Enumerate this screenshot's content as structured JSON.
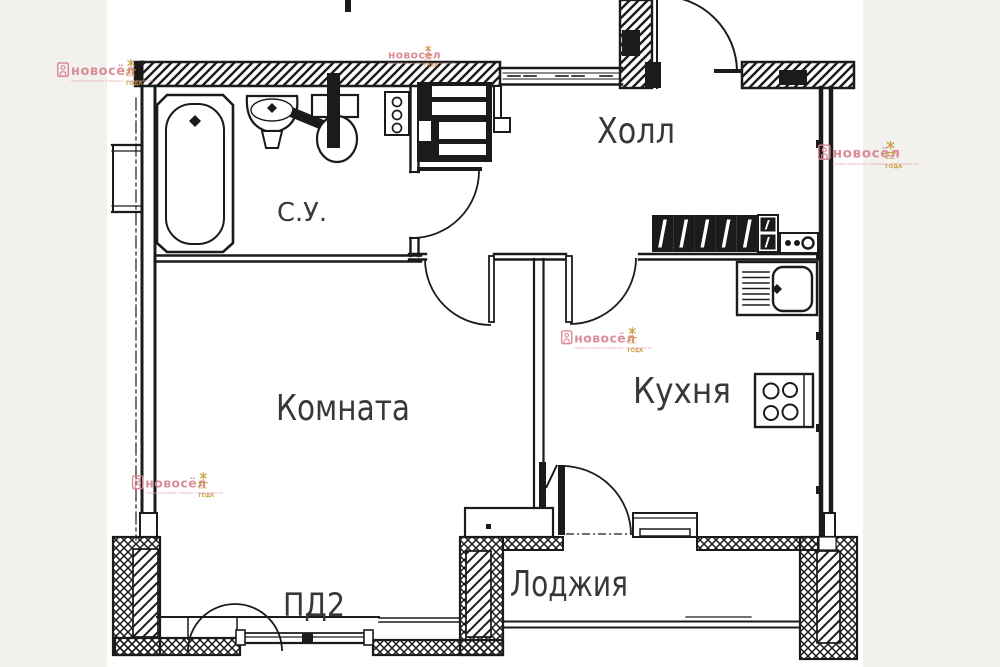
{
  "plan": {
    "rooms": {
      "hall": {
        "label": "Холл"
      },
      "bathroom": {
        "label": "С.У."
      },
      "living_room": {
        "label": "Комната"
      },
      "kitchen": {
        "label": "Кухня"
      },
      "loggia": {
        "label": "Лоджия"
      }
    },
    "annotations": {
      "balcony_unit": "ПД2"
    }
  },
  "watermark": {
    "brand": "новосёл",
    "tagline": "Профессиональные операции с недвижимостью",
    "emblem_caption": "ГОДА"
  },
  "colors": {
    "line": "#1b1b1b",
    "label": "#383838",
    "brand_pink": "#d9838f",
    "brand_pink_light": "#e3abb3",
    "brand_gold": "#c79b3f",
    "paper": "#ffffff",
    "backdrop": "#f2f1ee"
  }
}
